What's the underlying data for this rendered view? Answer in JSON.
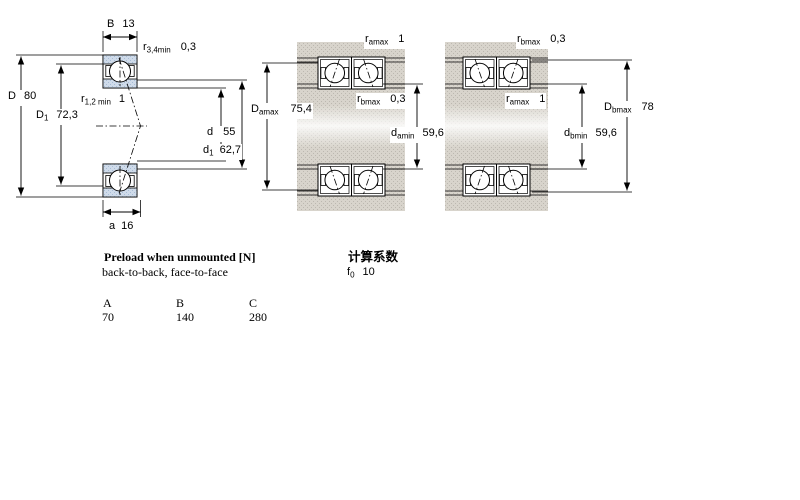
{
  "colors": {
    "ring_fill": "#cfdbea",
    "ring_dot": "#a8bdd6",
    "housing_fill": "#d8d4cc",
    "housing_dot": "#bcb8b0"
  },
  "left_drawing": {
    "description": "single bearing cross-section",
    "dims": {
      "B": {
        "symbol": "B",
        "sub": "",
        "value": "13"
      },
      "r34": {
        "symbol": "r",
        "sub": "3,4min",
        "value": "0,3"
      },
      "D": {
        "symbol": "D",
        "sub": "",
        "value": "80"
      },
      "D1": {
        "symbol": "D",
        "sub": "1",
        "value": "72,3"
      },
      "r12": {
        "symbol": "r",
        "sub": "1,2 min",
        "value": "1"
      },
      "d": {
        "symbol": "d",
        "sub": "",
        "value": "55"
      },
      "d1": {
        "symbol": "d",
        "sub": "1",
        "value": "62,7"
      },
      "a": {
        "symbol": "a",
        "sub": "",
        "value": "16"
      }
    }
  },
  "middle_drawing": {
    "description": "paired bearings mounted, a-side dimensions",
    "dims": {
      "r_amax": {
        "symbol": "r",
        "sub": "amax",
        "value": "1"
      },
      "D_amax": {
        "symbol": "D",
        "sub": "amax",
        "value": "75,4"
      },
      "r_bmax": {
        "symbol": "r",
        "sub": "bmax",
        "value": "0,3"
      },
      "d_amin": {
        "symbol": "d",
        "sub": "amin",
        "value": "59,6"
      }
    }
  },
  "right_drawing": {
    "description": "paired bearings mounted, b-side dimensions",
    "dims": {
      "r_bmax": {
        "symbol": "r",
        "sub": "bmax",
        "value": "0,3"
      },
      "r_amax": {
        "symbol": "r",
        "sub": "amax",
        "value": "1"
      },
      "D_bmax": {
        "symbol": "D",
        "sub": "bmax",
        "value": "78"
      },
      "d_bmin": {
        "symbol": "d",
        "sub": "bmin",
        "value": "59,6"
      }
    }
  },
  "preload": {
    "title": "Preload when unmounted [N]",
    "subtitle": "back-to-back, face-to-face",
    "columns": [
      "A",
      "B",
      "C"
    ],
    "values": [
      "70",
      "140",
      "280"
    ]
  },
  "factors": {
    "title": "计算系数",
    "f_symbol": "f",
    "f_sub": "0",
    "f_value": "10"
  }
}
